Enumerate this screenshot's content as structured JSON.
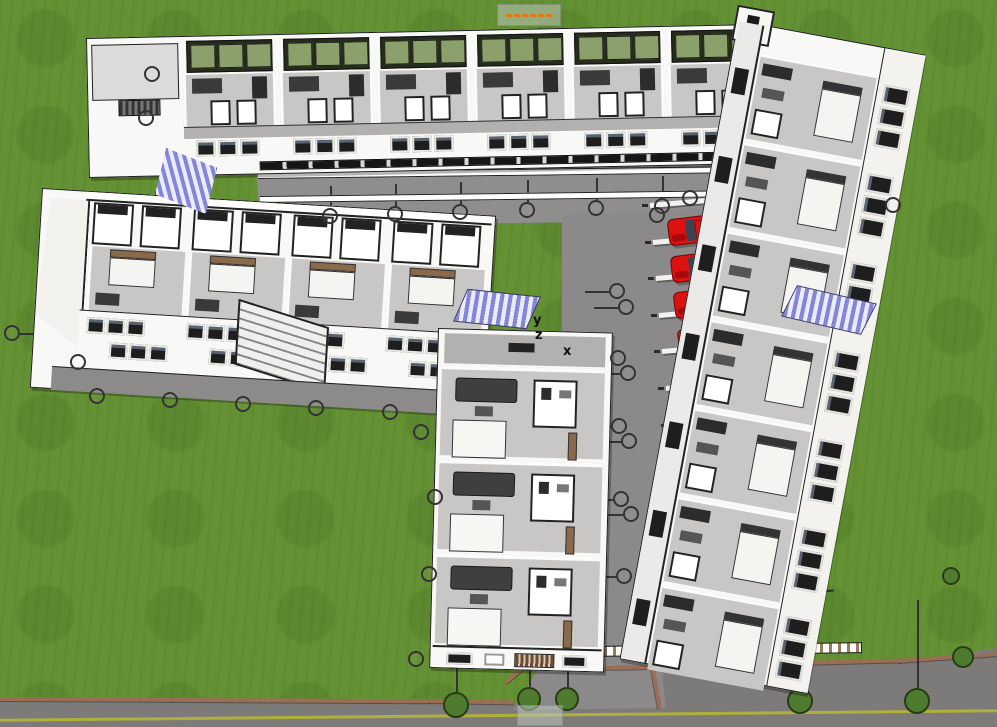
{
  "meta": {
    "view": "aerial 3d cutaway model of courtyard apartment complex with parking lot"
  },
  "axes": {
    "x": "x",
    "y": "y",
    "z": "z"
  },
  "palette": {
    "grass": "#649133",
    "road": "#7d7b79",
    "road_line": "#b5b535",
    "curb": "#996e55",
    "asphalt": "#8b8989",
    "walkway": "#908e8c",
    "plinth": "#8d8b89",
    "sidewalk": "#a3a1a0",
    "wall_white": "#f8f8f6",
    "outline": "#1c1c1c",
    "floor": "#c9c7c5",
    "floor_dark": "#b3b1af",
    "furniture_dark": "#3a3a3a",
    "glazing_green": "#8ca06b",
    "glazing_frame": "#252b1d",
    "window_dark": "#1e1e1e",
    "car_red": "#dd1111",
    "car_glass": "#3c4454",
    "stair_purple": "#8486da",
    "tree_fill": "#4e7b2f",
    "tree_line": "#283c14",
    "kitchen_brown": "#8a6a4a",
    "wood_brown": "#9a7a5a"
  },
  "cars": {
    "count": 11,
    "x0": 668,
    "y0": 216,
    "dx": 3.2,
    "dy": 36.6,
    "w": 58,
    "h": 27,
    "angle": -7
  },
  "bay_stripes": {
    "count": 12,
    "x0": 650,
    "y0": 203,
    "dx": 3.1,
    "dy": 36.6,
    "w": 66,
    "h": 5,
    "angle": -5
  },
  "bay_lines": {
    "count": 11,
    "x0": 724,
    "y0": 229,
    "dx": 3.2,
    "dy": 36.6,
    "w": 78,
    "angle": -4
  },
  "wings": {
    "top": {
      "x": 86,
      "y": 38,
      "w": 684,
      "h": 140,
      "angle": -1.2,
      "modules": 6,
      "module_w": 97,
      "module_x0": 95
    },
    "left": {
      "x": 42,
      "y": 188,
      "w": 455,
      "h": 200,
      "angle": 3.5,
      "modules": 4,
      "module_w": 100,
      "module_x0": 50
    },
    "right": {
      "x": 738,
      "y": 20,
      "w": 190,
      "h": 650,
      "angle": 10.5,
      "modules": 7,
      "module_h": 90,
      "module_y0": 28
    },
    "bottom": {
      "x": 438,
      "y": 328,
      "w": 175,
      "h": 340,
      "angle": 1.5,
      "modules": 3,
      "module_h": 94,
      "module_y0": 36
    }
  },
  "courtyard": {
    "walkway_poly": "polygon(256px 168px, 766px 162px, 770px 220px, 260px 226px)",
    "parking_poly": "polygon(562px 215px, 768px 206px, 810px 660px, 604px 666px, 598px 334px, 562px 336px)",
    "sidewalk": {
      "x": 766,
      "y": 208,
      "w": 30,
      "h": 456,
      "angle": 5
    },
    "wall": {
      "x": 444,
      "y": 648,
      "w": 418,
      "h": 11,
      "angle": -0.8
    }
  },
  "road": {
    "top": 640,
    "h": 87,
    "poly": "polygon(0px 60px, 430px 62px, 516px 63px, 548px 46px, 600px 24px, 662px 20px, 764px 26px, 900px 22px, 997px 8px, 997px 87px, 0px 87px)",
    "line_y": 74,
    "driveway": {
      "x": 510,
      "y": 652,
      "w": 160,
      "h": 58,
      "poly": "polygon(34px 6px, 150px 2px, 156px 56px, 4px 58px)"
    }
  },
  "curbs": [
    {
      "x": 0,
      "y": 697,
      "w": 430,
      "a": 0.3
    },
    {
      "x": 428,
      "y": 699,
      "w": 86,
      "a": 1
    },
    {
      "x": 505,
      "y": 681,
      "w": 46,
      "a": -40
    },
    {
      "x": 598,
      "y": 668,
      "w": 58,
      "a": -14
    },
    {
      "x": 652,
      "y": 662,
      "w": 46,
      "a": 80
    },
    {
      "x": 610,
      "y": 666,
      "w": 292,
      "a": -1.5
    },
    {
      "x": 898,
      "y": 659,
      "w": 99,
      "a": -4
    }
  ],
  "trees": [
    {
      "x": 456,
      "y": 705,
      "r": 13,
      "stem": 44
    },
    {
      "x": 529,
      "y": 699,
      "r": 12,
      "stem": 34
    },
    {
      "x": 567,
      "y": 699,
      "r": 12,
      "stem": 34
    },
    {
      "x": 800,
      "y": 701,
      "r": 13,
      "stem": 46
    },
    {
      "x": 917,
      "y": 701,
      "r": 13,
      "stem": 88
    },
    {
      "x": 963,
      "y": 657,
      "r": 11,
      "stem": 0
    },
    {
      "x": 951,
      "y": 576,
      "r": 9,
      "stem": 0
    }
  ],
  "markers": [
    {
      "x": 152,
      "y": 74
    },
    {
      "x": 146,
      "y": 118
    },
    {
      "x": 12,
      "y": 333,
      "stem": "right",
      "len": 30
    },
    {
      "x": 78,
      "y": 362,
      "stem": "right",
      "len": 26
    },
    {
      "x": 97,
      "y": 396
    },
    {
      "x": 170,
      "y": 400
    },
    {
      "x": 243,
      "y": 404
    },
    {
      "x": 316,
      "y": 408
    },
    {
      "x": 390,
      "y": 412
    },
    {
      "x": 421,
      "y": 432
    },
    {
      "x": 435,
      "y": 497
    },
    {
      "x": 429,
      "y": 574
    },
    {
      "x": 416,
      "y": 659
    },
    {
      "x": 330,
      "y": 216,
      "stem": "up",
      "len": 22
    },
    {
      "x": 395,
      "y": 214,
      "stem": "up",
      "len": 22
    },
    {
      "x": 460,
      "y": 212,
      "stem": "up",
      "len": 22
    },
    {
      "x": 527,
      "y": 210,
      "stem": "up",
      "len": 22
    },
    {
      "x": 596,
      "y": 208,
      "stem": "up",
      "len": 22
    },
    {
      "x": 662,
      "y": 206,
      "stem": "up",
      "len": 22
    },
    {
      "x": 657,
      "y": 215
    },
    {
      "x": 690,
      "y": 198
    },
    {
      "x": 617,
      "y": 291,
      "stem": "left",
      "len": 24
    },
    {
      "x": 626,
      "y": 307,
      "stem": "left",
      "len": 24
    },
    {
      "x": 618,
      "y": 358,
      "stem": "left",
      "len": 24
    },
    {
      "x": 628,
      "y": 373,
      "stem": "left",
      "len": 24
    },
    {
      "x": 619,
      "y": 426,
      "stem": "left",
      "len": 24
    },
    {
      "x": 629,
      "y": 441,
      "stem": "left",
      "len": 24
    },
    {
      "x": 621,
      "y": 499,
      "stem": "left",
      "len": 24
    },
    {
      "x": 631,
      "y": 514,
      "stem": "left",
      "len": 24
    },
    {
      "x": 624,
      "y": 576,
      "stem": "left",
      "len": 24
    },
    {
      "x": 893,
      "y": 205
    }
  ],
  "stairs": [
    {
      "x": 155,
      "y": 148,
      "w": 62,
      "h": 66,
      "rot": 0,
      "skew": 0,
      "clip": "polygon(18% 0, 100% 30%, 82% 100%, 0 70%)"
    },
    {
      "x": 460,
      "y": 292,
      "w": 74,
      "h": 34,
      "rot": 6,
      "skew": -18,
      "clip": ""
    },
    {
      "x": 788,
      "y": 293,
      "w": 82,
      "h": 34,
      "rot": 13,
      "skew": -14,
      "clip": ""
    }
  ],
  "axes_pos": {
    "x": [
      563,
      345
    ],
    "y": [
      533,
      314
    ],
    "z": [
      535,
      329
    ]
  },
  "tags": {
    "top": {
      "x": 497,
      "y": 4,
      "w": 64,
      "h": 22
    },
    "bottom": {
      "x": 517,
      "y": 705,
      "w": 46,
      "h": 21
    }
  }
}
